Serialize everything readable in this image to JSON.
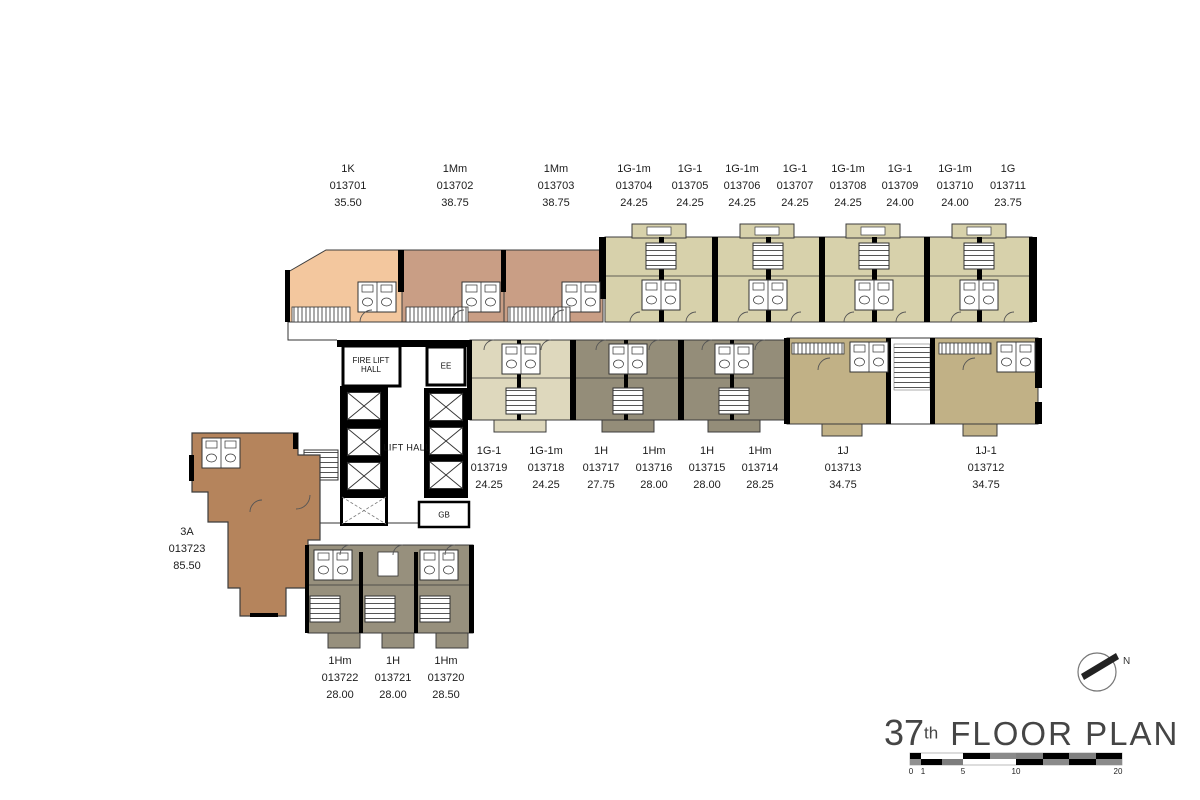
{
  "title": {
    "number": "37",
    "suffix": "th",
    "text": "FLOOR PLAN"
  },
  "compass": {
    "label": "N"
  },
  "scale_bar": {
    "ticks": [
      "0",
      "1",
      "5",
      "10",
      "20"
    ]
  },
  "core_labels": {
    "fire_lift_hall_1": "FIRE LIFT",
    "fire_lift_hall_2": "HALL",
    "ee": "EE",
    "lift_hall": "LIFT HALL",
    "gb": "GB"
  },
  "units": {
    "top_row": [
      {
        "type": "1K",
        "number": "013701",
        "area": "35.50"
      },
      {
        "type": "1Mm",
        "number": "013702",
        "area": "38.75"
      },
      {
        "type": "1Mm",
        "number": "013703",
        "area": "38.75"
      },
      {
        "type": "1G-1m",
        "number": "013704",
        "area": "24.25"
      },
      {
        "type": "1G-1",
        "number": "013705",
        "area": "24.25"
      },
      {
        "type": "1G-1m",
        "number": "013706",
        "area": "24.25"
      },
      {
        "type": "1G-1",
        "number": "013707",
        "area": "24.25"
      },
      {
        "type": "1G-1m",
        "number": "013708",
        "area": "24.25"
      },
      {
        "type": "1G-1",
        "number": "013709",
        "area": "24.00"
      },
      {
        "type": "1G-1m",
        "number": "013710",
        "area": "24.00"
      },
      {
        "type": "1G",
        "number": "013711",
        "area": "23.75"
      }
    ],
    "middle_row": [
      {
        "type": "1G-1",
        "number": "013719",
        "area": "24.25"
      },
      {
        "type": "1G-1m",
        "number": "013718",
        "area": "24.25"
      },
      {
        "type": "1H",
        "number": "013717",
        "area": "27.75"
      },
      {
        "type": "1Hm",
        "number": "013716",
        "area": "28.00"
      },
      {
        "type": "1H",
        "number": "013715",
        "area": "28.00"
      },
      {
        "type": "1Hm",
        "number": "013714",
        "area": "28.25"
      },
      {
        "type": "1J",
        "number": "013713",
        "area": "34.75"
      },
      {
        "type": "1J-1",
        "number": "013712",
        "area": "34.75"
      }
    ],
    "left": [
      {
        "type": "3A",
        "number": "013723",
        "area": "85.50"
      }
    ],
    "bottom_row": [
      {
        "type": "1Hm",
        "number": "013722",
        "area": "28.00"
      },
      {
        "type": "1H",
        "number": "013721",
        "area": "28.00"
      },
      {
        "type": "1Hm",
        "number": "013720",
        "area": "28.50"
      }
    ]
  },
  "colors": {
    "unit_1k": "#f3c79e",
    "unit_1mm": "#c99e85",
    "unit_1g_top": "#d7d1ab",
    "unit_1g_mid": "#ded8bd",
    "unit_1h": "#948d79",
    "unit_1j": "#c1b186",
    "unit_3a": "#b5845c",
    "unit_bottom": "#97907d",
    "wall": "#000000",
    "title_text": "#454545"
  }
}
